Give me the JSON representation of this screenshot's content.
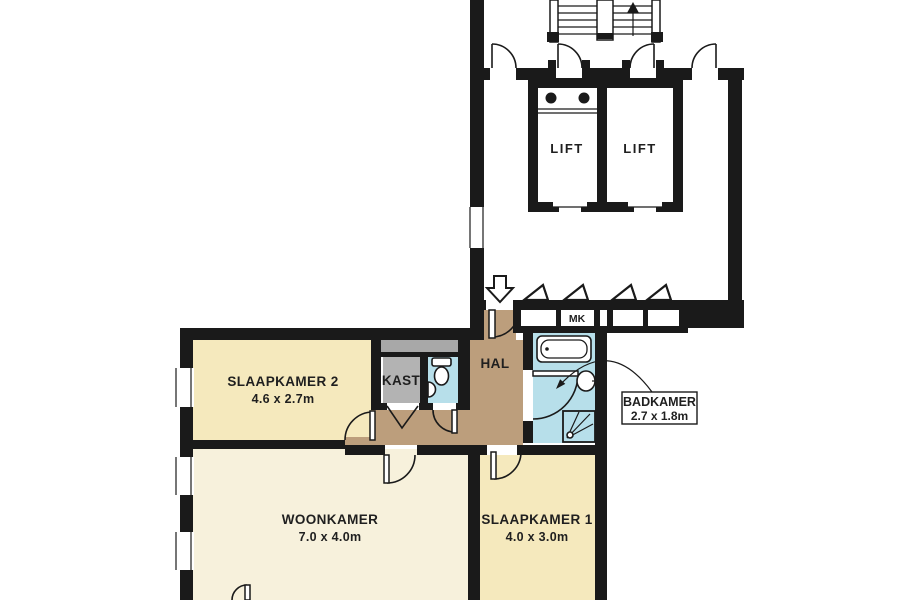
{
  "floorplan": {
    "rooms": {
      "slaapkamer2": {
        "name": "SLAAPKAMER 2",
        "dims": "4.6 x 2.7m"
      },
      "woonkamer": {
        "name": "WOONKAMER",
        "dims": "7.0 x 4.0m"
      },
      "slaapkamer1": {
        "name": "SLAAPKAMER 1",
        "dims": "4.0 x 3.0m"
      },
      "badkamer": {
        "name": "BADKAMER",
        "dims": "2.7 x 1.8m"
      },
      "kast": {
        "name": "KAST"
      },
      "hal": {
        "name": "HAL"
      },
      "mk": {
        "name": "MK"
      },
      "lift_left": {
        "name": "LIFT"
      },
      "lift_right": {
        "name": "LIFT"
      }
    },
    "colors": {
      "bedroom_yellow": "#F5E9BD",
      "living_cream": "#F7F1DC",
      "hall_tan": "#BC9E7C",
      "bath_blue": "#B7DFEA",
      "bath_light": "#E4F2F7",
      "closet_gray": "#B3B3B3",
      "duct_gray": "#A8A8A8",
      "wall_black": "#1a1a1a",
      "white": "#ffffff"
    }
  }
}
